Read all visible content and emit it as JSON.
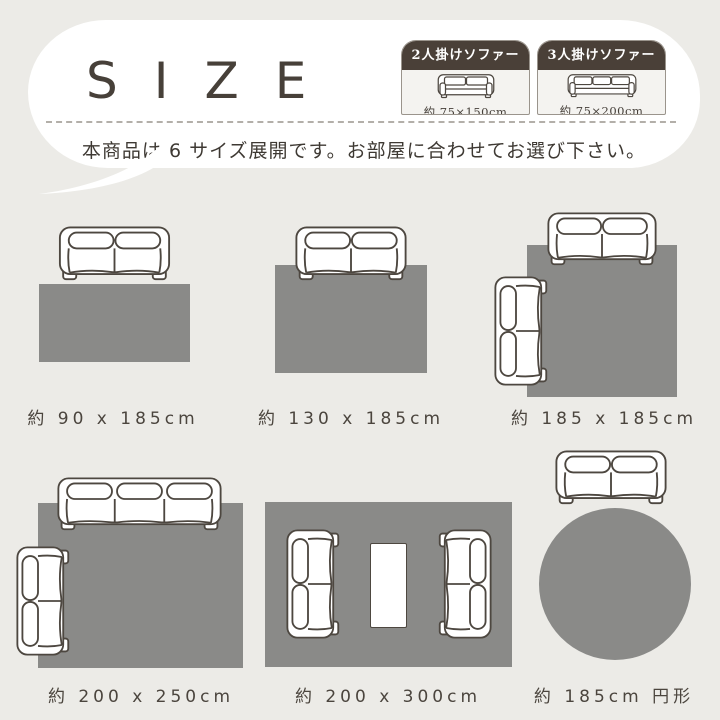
{
  "header": {
    "title": "SIZE",
    "subtitle": "本商品は 6 サイズ展開です。お部屋に合わせてお選び下さい。"
  },
  "legend": {
    "cards": [
      {
        "label": "2人掛けソファー",
        "size": "約 75×150cm",
        "icon": "sofa-front-2seat-icon"
      },
      {
        "label": "3人掛けソファー",
        "size": "約 75×200cm",
        "icon": "sofa-front-3seat-icon"
      }
    ]
  },
  "sizes": [
    {
      "label": "約 90 x 185cm",
      "shape": "rectangle",
      "sofas": [
        "2seat-top"
      ]
    },
    {
      "label": "約 130 x 185cm",
      "shape": "rectangle",
      "sofas": [
        "2seat-top"
      ]
    },
    {
      "label": "約 185 x 185cm",
      "shape": "rectangle",
      "sofas": [
        "2seat-top",
        "2seat-side"
      ]
    },
    {
      "label": "約 200 x 250cm",
      "shape": "rectangle",
      "sofas": [
        "3seat-top",
        "2seat-side"
      ]
    },
    {
      "label": "約 200 x 300cm",
      "shape": "rectangle",
      "sofas": [
        "2seat-side",
        "2seat-side"
      ],
      "extras": [
        "table"
      ]
    },
    {
      "label": "約 185cm 円形",
      "shape": "circle",
      "sofas": [
        "2seat-top"
      ]
    }
  ],
  "colors": {
    "background": "#ecebe7",
    "bubble": "#ffffff",
    "title_text": "#474039",
    "label_text": "#4b453e",
    "rug": "#8a8a88",
    "sofa_outline": "#4d4740",
    "legend_header_bg": "#4a4038",
    "legend_header_text": "#ffffff",
    "legend_body_bg": "#f4f3f0",
    "dashed_line": "#b3afa9"
  }
}
